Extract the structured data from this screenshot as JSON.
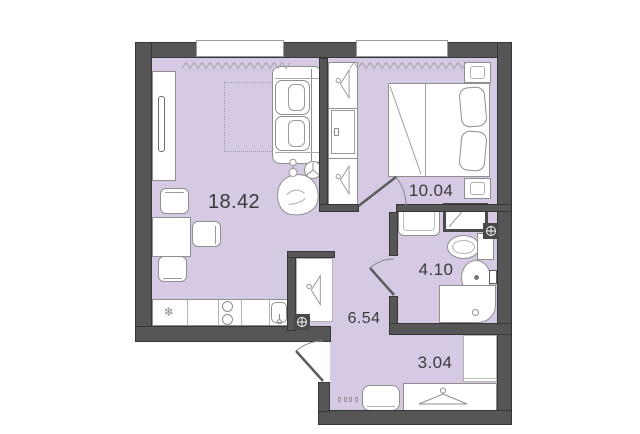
{
  "floor_plan": {
    "rooms": {
      "living": {
        "name": "living-room-kitchen",
        "area": "18.42"
      },
      "bedroom": {
        "name": "bedroom",
        "area": "10.04"
      },
      "bathroom": {
        "name": "bathroom",
        "area": "4.10"
      },
      "hallway": {
        "name": "hallway",
        "area": "6.54"
      },
      "entry": {
        "name": "entry-hall",
        "area": "3.04"
      }
    },
    "symbols": {
      "fridge": "❄"
    },
    "colors": {
      "room_fill": "#d5c9e3",
      "wall": "#565656",
      "furniture_outline": "#8f8f8f",
      "label_text": "#3b3b3b"
    }
  }
}
